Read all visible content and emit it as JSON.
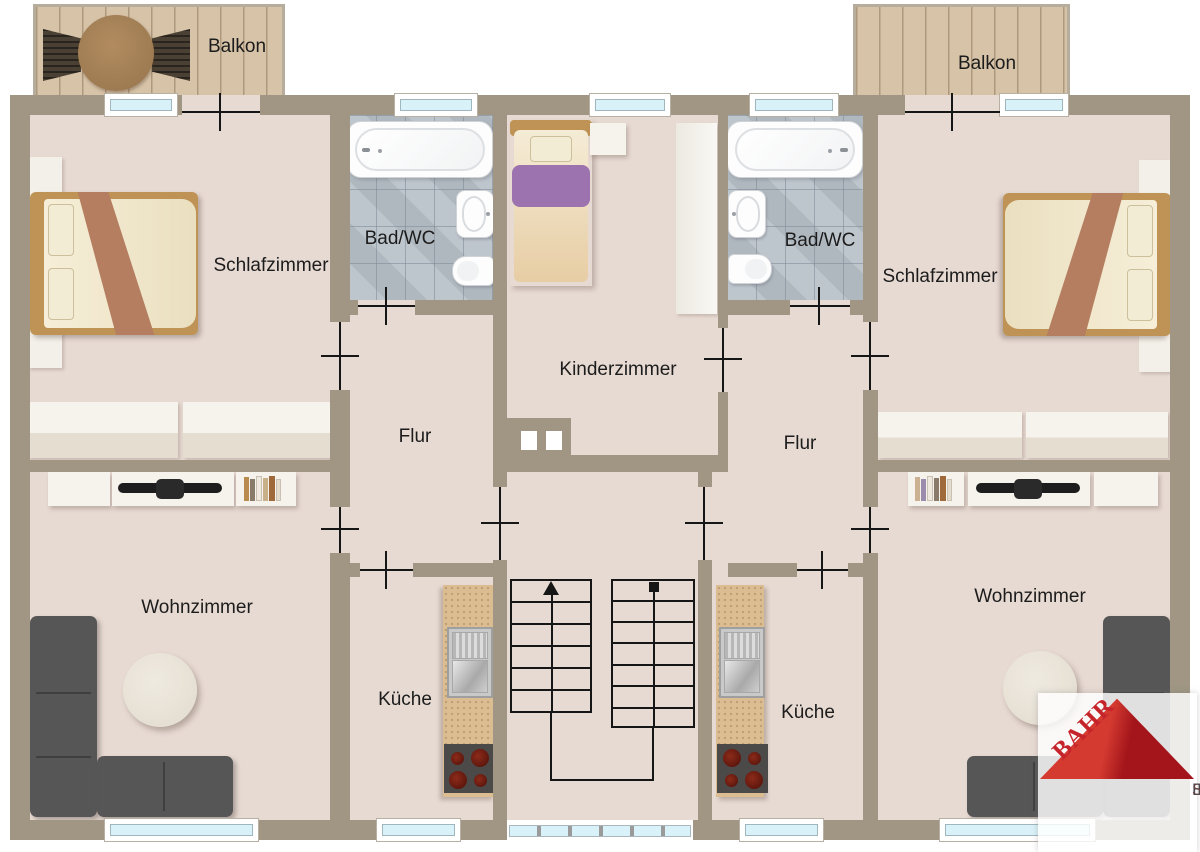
{
  "colors": {
    "wall": "#a09683",
    "floor": "#e7dad2",
    "tile": "#b7bfc7",
    "balcony_wood": "#d7c3a8",
    "kitchen_counter": "#dcbd92",
    "sofa_gray": "#575656",
    "line_black": "#161616",
    "window_glass": "#d9f1f8",
    "bed_frame": "#bf9355",
    "bed_blanket": "#b57e61",
    "kid_blanket": "#9c73ae",
    "stove_dark": "#4c4a49",
    "logo_red": "#c5242b",
    "logo_gray": "#4c4c4e"
  },
  "labels": {
    "balcony_left": "Balkon",
    "balcony_right": "Balkon",
    "bedroom_left": "Schlafzimmer",
    "bedroom_right": "Schlafzimmer",
    "bath_left": "Bad/WC",
    "bath_right": "Bad/WC",
    "kids_room": "Kinderzimmer",
    "hall_left": "Flur",
    "hall_right": "Flur",
    "living_left": "Wohnzimmer",
    "living_right": "Wohnzimmer",
    "kitchen_left": "Küche",
    "kitchen_right": "Küche"
  },
  "logo": {
    "brand": "BAHR",
    "line1": "IMMOBILIEN",
    "line2": "SERVICE",
    "line3": "BÄRBEL BAHR"
  }
}
